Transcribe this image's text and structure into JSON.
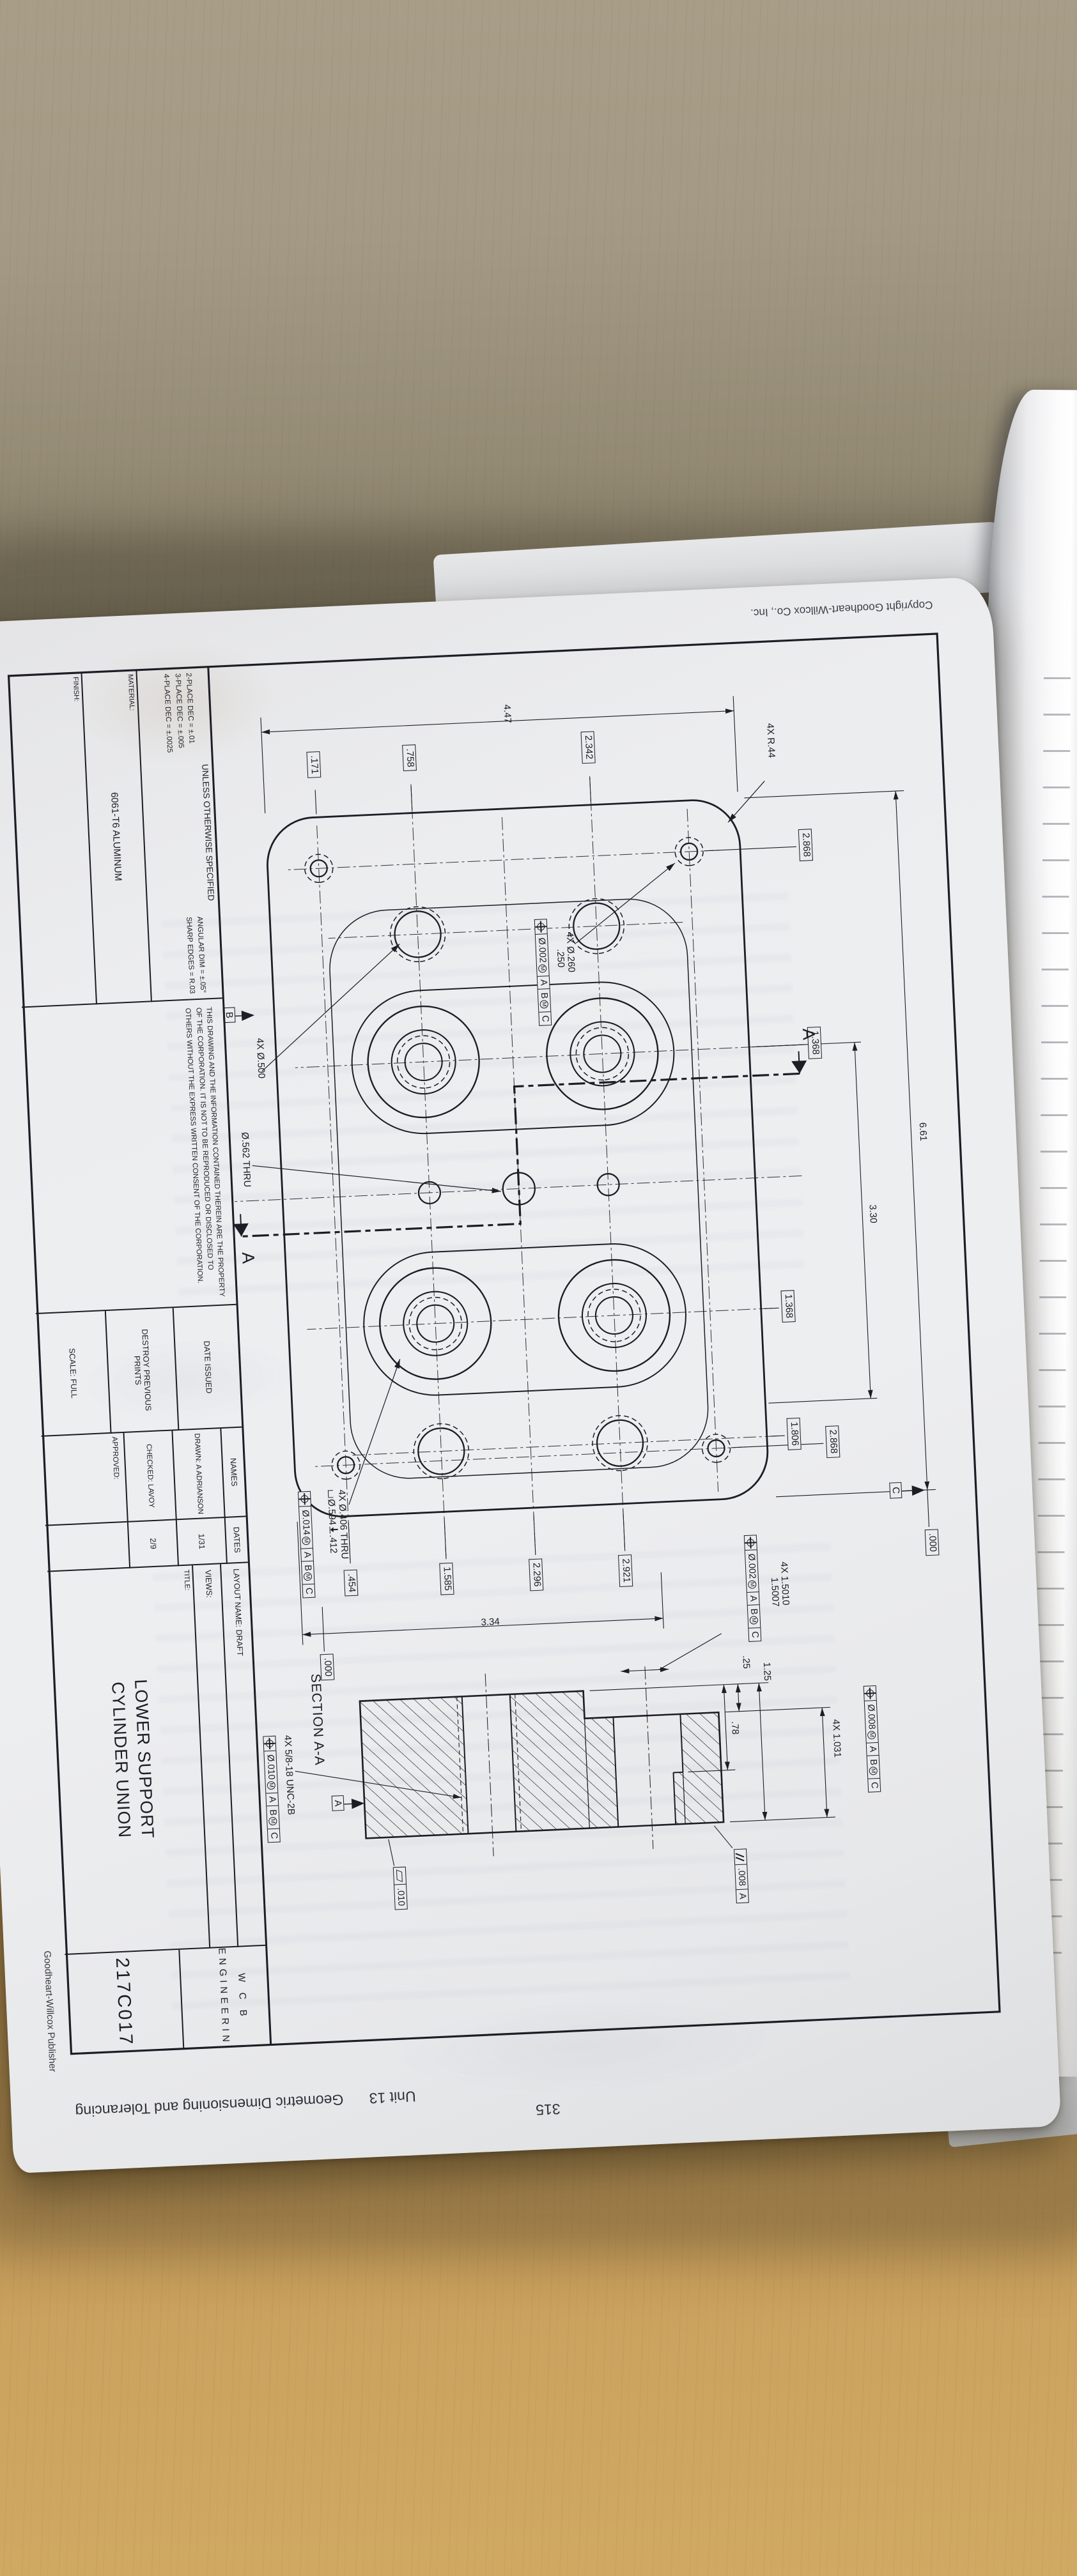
{
  "margins": {
    "heading_bold": "PR 13-1.",
    "heading_rest": " Cylinder Union Lower Support",
    "footer_unit": "Unit 13",
    "footer_title": "Geometric Dimensioning and Tolerancing",
    "footer_page": "315",
    "copyright": "Copyright Goodheart-Willcox Co., Inc.",
    "publisher": "Goodheart-Willcox Publisher"
  },
  "title_block": {
    "unless": "UNLESS OTHERWISE SPECIFIED",
    "tol_a1": "2-PLACE DEC = ±.01",
    "tol_a2": "3-PLACE DEC = ±.005",
    "tol_a3": "4-PLACE DEC = ±.0025",
    "tol_b1": "ANGULAR DIM = ±.05°",
    "tol_b2": "SHARP EDGES = R.03",
    "material_label": "MATERIAL:",
    "material": "6061-T6 ALUMINUM",
    "finish_label": "FINISH:",
    "legal": "THIS DRAWING AND THE INFORMATION CONTAINED THEREIN ARE THE PROPERTY OF THE CORPORATION. IT IS NOT TO BE REPRODUCED OR DISCLOSED TO OTHERS WITHOUT THE EXPRESS WRITTEN CONSENT OF THE CORPORATION.",
    "date_issued": "DATE ISSUED",
    "destroy": "DESTROY PREVIOUS PRINTS",
    "scale": "SCALE:  FULL",
    "names_h": "NAMES",
    "dates_h": "DATES",
    "drawn": "DRAWN:  A ADRIANSON",
    "drawn_date": "1/31",
    "checked": "CHECKED:  LAVOY",
    "checked_date": "2/9",
    "approved": "APPROVED:",
    "layout_name": "LAYOUT NAME:   DRAFT",
    "views": "VIEWS:",
    "title_label": "TITLE:",
    "title_line1": "LOWER SUPPORT",
    "title_line2": "CYLINDER UNION",
    "company1": "W C B",
    "company2": "ENGINEERING",
    "drawing_number": "217C017"
  },
  "plan": {
    "d447": "4.47",
    "d661": "6.61",
    "d330": "3.30",
    "d334": "3.34",
    "b758": ".758",
    "b171": ".171",
    "b2342": "2.342",
    "t2868a": "2.868",
    "t1368a": "1.368",
    "t000": ".000",
    "t1368b": "1.368",
    "t1806": "1.806",
    "t2868b": "2.868",
    "r2921": "2.921",
    "r2296": "2.296",
    "r1585": "1.585",
    "r454": ".454",
    "r000": ".000",
    "r44": "4X R.44",
    "h260_l1": "4X Ø.260",
    "h260_l2": ".250",
    "fcf260": [
      "@pos",
      "Ø.002(M)",
      "A",
      "B(M)",
      "C"
    ],
    "h500": "4X Ø.500",
    "h562": "Ø.562  THRU",
    "h406_l1": "4X Ø.406 THRU",
    "h406_l2": "Ø.594",
    "h406_depth": ".412",
    "fcf406": [
      "@pos",
      "Ø.014(M)",
      "A",
      "B(M)",
      "C"
    ],
    "datum_b": "B",
    "datum_c": "C",
    "cut_label_1": "A",
    "cut_label_2": "A"
  },
  "section": {
    "label": "SECTION A-A",
    "d1031": "4X 1.031",
    "fcf1031": [
      "@pos",
      "Ø.008(M)",
      "A",
      "B(M)",
      "C"
    ],
    "d1501_l1": "4X 1.5010",
    "d1501_l2": "1.5007",
    "fcf1501": [
      "@pos",
      "Ø.002(M)",
      "A",
      "B(M)",
      "C"
    ],
    "thread": "4X 5/8-18 UNC-2B",
    "fcf_thread": [
      "@pos",
      "Ø.010(M)",
      "A",
      "B(M)",
      "C"
    ],
    "fcf_par": [
      "@par",
      ".008",
      "A"
    ],
    "fcf_flat": [
      "@flat",
      ".010"
    ],
    "datum_a": "A",
    "d25": ".25",
    "d78": ".78",
    "d125": "1.25"
  }
}
